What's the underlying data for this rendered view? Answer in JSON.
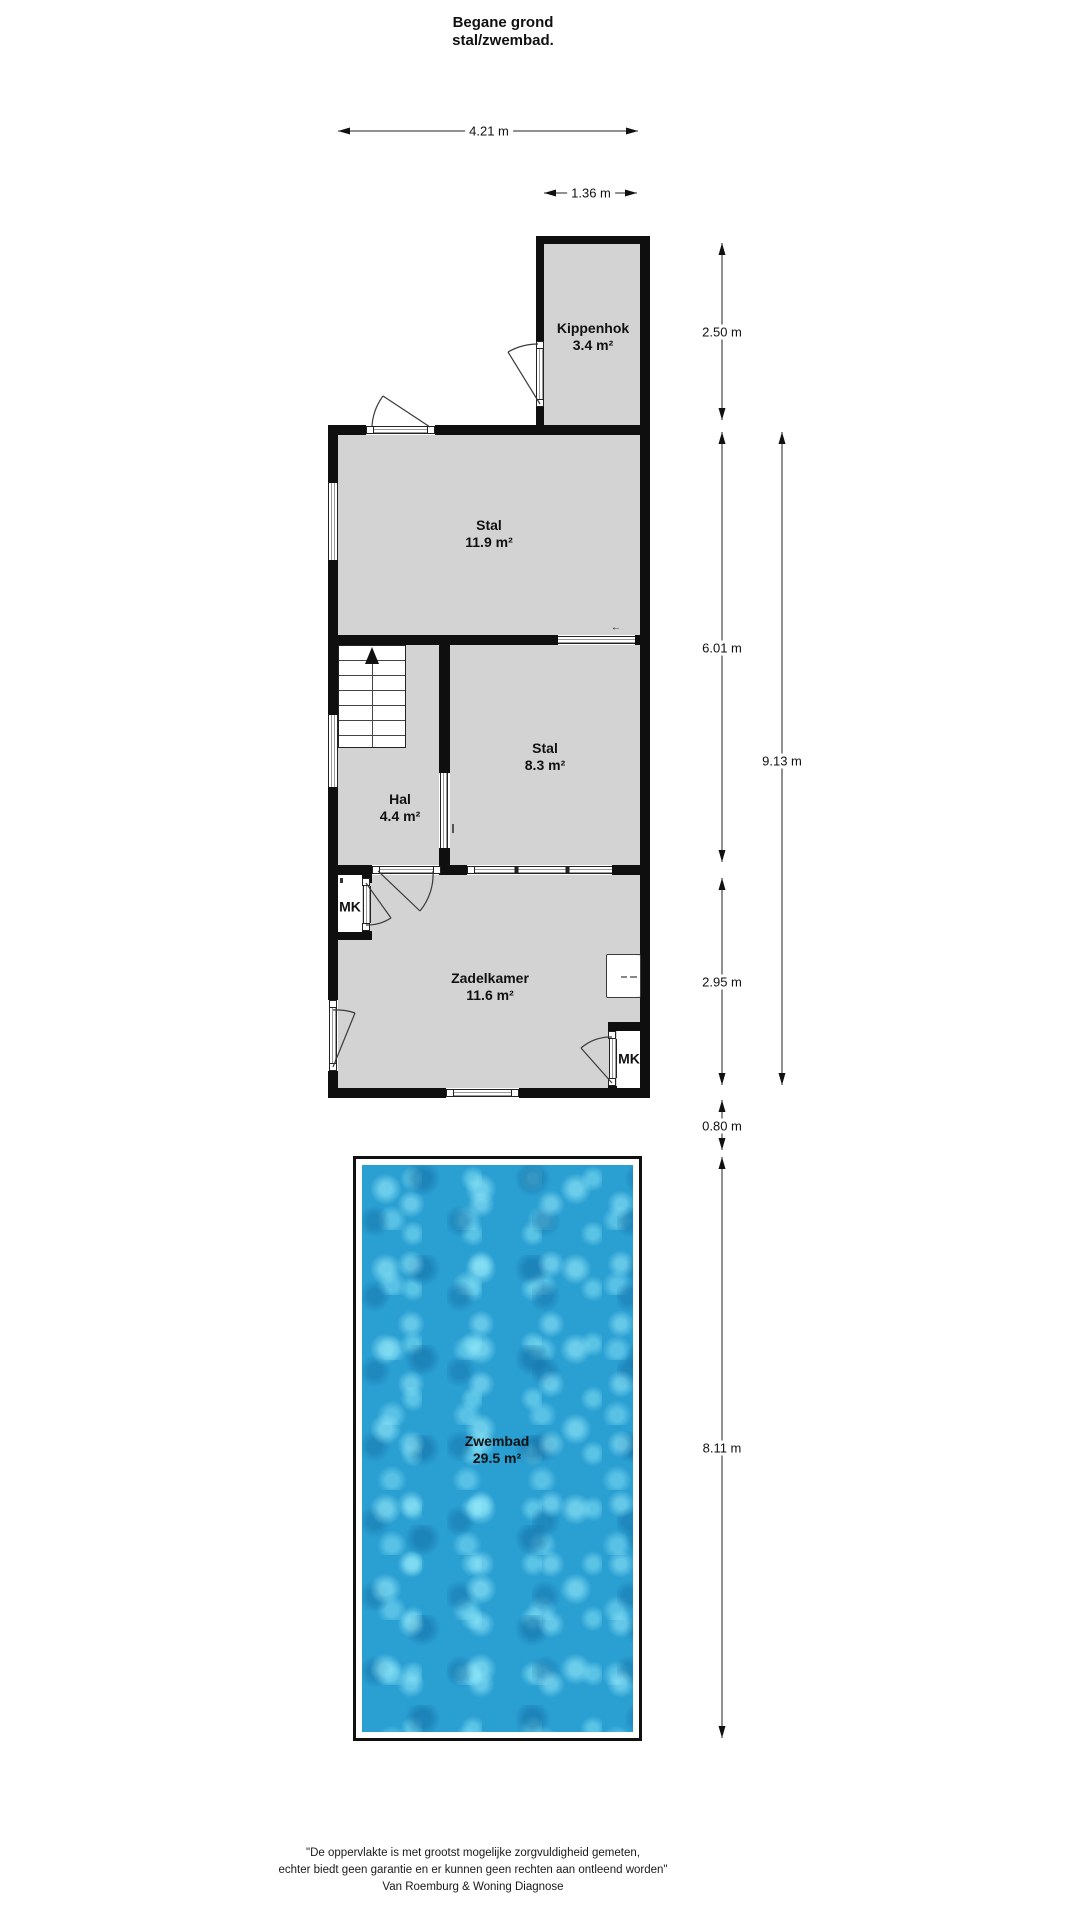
{
  "title": {
    "line1": "Begane grond",
    "line2": "stal/zwembad."
  },
  "rooms": [
    {
      "name": "Kippenhok",
      "area": "3.4 m²"
    },
    {
      "name": "Stal",
      "area": "11.9 m²"
    },
    {
      "name": "Stal",
      "area": "8.3 m²"
    },
    {
      "name": "Hal",
      "area": "4.4 m²"
    },
    {
      "name": "Zadelkamer",
      "area": "11.6 m²"
    },
    {
      "name": "Zwembad",
      "area": "29.5 m²"
    }
  ],
  "closets": [
    {
      "label": "MK"
    },
    {
      "label": "MK"
    }
  ],
  "dimensions": {
    "total_width": "4.21 m",
    "kippenhok_width": "1.36 m",
    "kippenhok_height": "2.50 m",
    "stal_section_height": "6.01 m",
    "building_height": "9.13 m",
    "zadelkamer_height": "2.95 m",
    "building_pool_gap": "0.80 m",
    "zwembad_height": "8.11 m"
  },
  "glyphs": {
    "window_arrow": "←"
  },
  "footer": {
    "line1": "\"De oppervlakte is met grootst mogelijke zorgvuldigheid gemeten,",
    "line2": "echter biedt geen garantie en er kunnen geen rechten aan ontleend worden\"",
    "line3": "Van Roemburg & Woning Diagnose"
  },
  "colors": {
    "wall": "#0f0f0f",
    "room_fill": "#d3d3d3",
    "water_base": "#2a9fd2",
    "water_light": "#8fe0f4",
    "water_dark": "#1b84bb"
  }
}
